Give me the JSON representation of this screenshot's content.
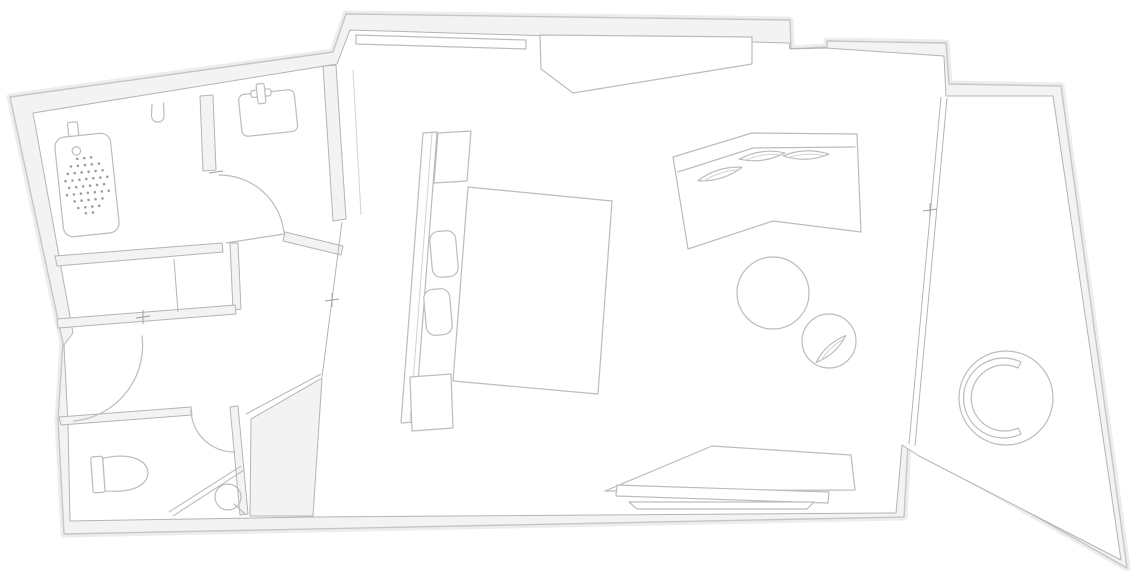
{
  "meta": {
    "label": "Hotel room floor plan, top-down architectural drawing, no text labels",
    "orientation": "plan rotated slightly counter-clockwise"
  },
  "colors": {
    "page_bg": "#ffffff",
    "floor": "#ffffff",
    "wall_fill": "#f3f3f3",
    "wall_edge": "#c6c6c6",
    "inner_edge": "#b4b4b4",
    "furniture_line": "#bcbcbc",
    "furniture_soft": "#d2d2d2",
    "detail_line": "#9c9c9c",
    "halo": "#ededed"
  },
  "rooms": [
    {
      "id": "bathroom",
      "fixtures": [
        "bathtub with drain dots and tap",
        "hand shower on wall"
      ]
    },
    {
      "id": "vanity",
      "fixtures": [
        "washbasin with faucet",
        "door swing into room"
      ]
    },
    {
      "id": "closet",
      "fixtures": [
        "shelf divider"
      ]
    },
    {
      "id": "vestibule",
      "fixtures": [
        "entry door swing",
        "survey cross marks"
      ]
    },
    {
      "id": "wc",
      "fixtures": [
        "toilet with cistern",
        "corner shower screen",
        "floor drain"
      ]
    },
    {
      "id": "bedroom",
      "fixtures": [
        "wardrobe rail",
        "angled closet",
        "headboard",
        "two nightstands",
        "two pillows",
        "double bed mattress",
        "chevron sofa with three cushions",
        "round coffee table",
        "round lounge chair with cushion",
        "console desk with shelf"
      ]
    },
    {
      "id": "balcony",
      "fixtures": [
        "round papasan chair with C backrest",
        "window wall with tick mark"
      ]
    }
  ],
  "counts": {
    "sofa_cushions": 3,
    "pillows": 2,
    "nightstands": 2,
    "door_swings": 3,
    "survey_crosses": 4,
    "round_tables": 1
  }
}
